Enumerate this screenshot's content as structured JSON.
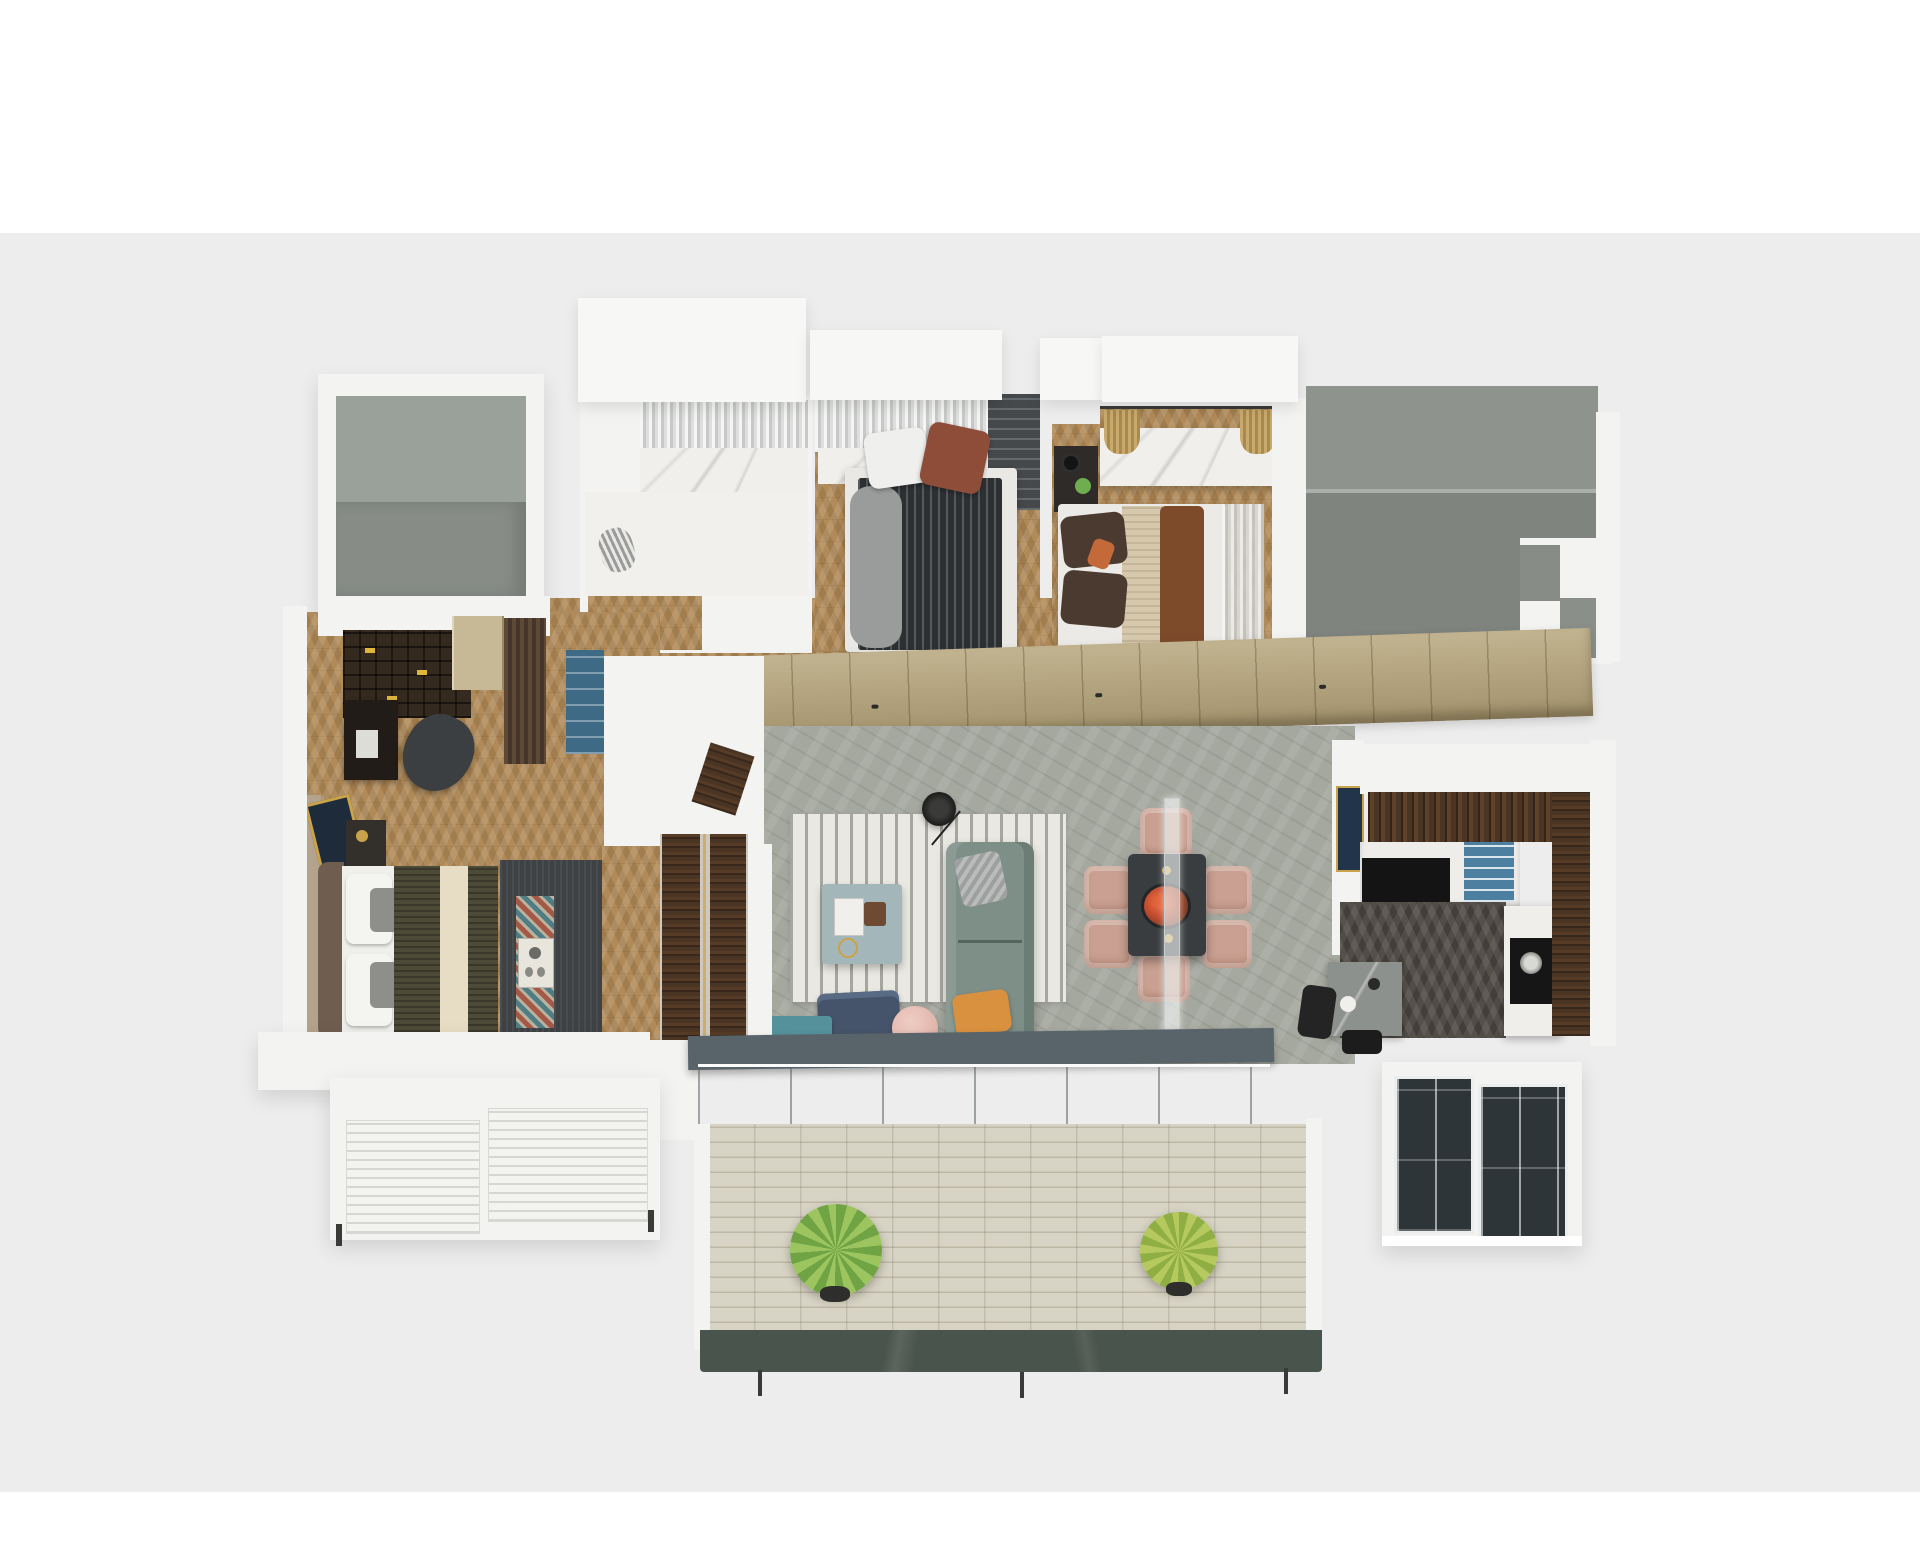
{
  "scene": {
    "type": "3d-floor-plan-render",
    "view": "top-down axonometric render of a three-bedroom apartment",
    "background_top": "#ffffff",
    "background_band": "#ededed",
    "has_text": false
  },
  "palette": {
    "wall_white": "#f3f3f1",
    "roof_white": "#f7f7f5",
    "terrace_gray_light": "#9aa09a",
    "terrace_gray_dark": "#878c87",
    "void_gray_light": "#8e938e",
    "void_gray_dark": "#7f847f",
    "marble_white": "#f0efec",
    "wood_oak": "#b08a58",
    "wood_walnut": "#4a3423",
    "wood_dark_floor": "#56504a",
    "wardrobe_beige": "#b6a784",
    "stone_floor": "#a5a89f",
    "rug_white": "#e9e8e2",
    "sofa_green": "#7e8f88",
    "armchair_navy": "#46546b",
    "pouf_pink": "#e3b8ae",
    "bench_teal": "#55919b",
    "coffee_table_blue": "#a3b7ba",
    "dining_table_dark": "#3a3d3f",
    "chair_pink": "#c9a091",
    "flower_orange": "#e0633a",
    "duvet_dark": "#2d3033",
    "blanket_olive": "#4d4a38",
    "blanket_cream": "#e7ddc4",
    "blanket_beige": "#d6c8ad",
    "throw_brown": "#7d4b2a",
    "pillow_rust": "#8e4d39",
    "pillow_orange": "#d9913f",
    "rug_dark": "#3f4245",
    "runner_teal": "#4f7d85",
    "runner_red": "#a65847",
    "curtain_gray": "#c6c9c7",
    "closet_dark": "#45494c",
    "kitchen_shelf_blue": "#4d7fa0",
    "beam_slate": "#59646a",
    "deck_light": "#d8d4c5",
    "fascia_green": "#49544c",
    "plant_green": "#6fa344",
    "balcony_glass_dark": "#2e3538",
    "art_navy": "#22344a",
    "gold_accent": "#c9a24b",
    "book_yellow": "#e0b63b"
  },
  "rooms": [
    {
      "id": "terrace-room-top-left",
      "floor": "two-tone gray concrete",
      "items": [
        "empty room"
      ]
    },
    {
      "id": "bathroom",
      "floor": "white marble",
      "items": [
        "curtain-wall",
        "marble-shower",
        "white-vanity-floor",
        "zebra-ornament",
        "stool",
        "oak-threshold"
      ]
    },
    {
      "id": "bedroom-2",
      "floor": "herringbone oak",
      "items": [
        "dark-striped-double-bed",
        "white-pillow",
        "rust-pillow",
        "gray-throw",
        "marble-headboard-wall",
        "dark-closet"
      ]
    },
    {
      "id": "bedroom-3",
      "floor": "herringbone oak",
      "items": [
        "beige-double-bed",
        "brown-throw",
        "marble-desk",
        "dried-grass-tassels",
        "nightstand-with-lamp-and-plant",
        "gray-curtain"
      ]
    },
    {
      "id": "study",
      "floor": "herringbone oak",
      "items": [
        "bookshelf",
        "desk",
        "office-chair",
        "tan-closet",
        "brown-curtain",
        "blue-cabinet"
      ]
    },
    {
      "id": "master-bedroom",
      "floor": "herringbone oak",
      "items": [
        "double-bed-olive-cream-blanket",
        "headboard",
        "pillows",
        "dark-rug",
        "zigzag-runner",
        "breakfast-tray",
        "mirror",
        "nightstand",
        "walnut-wardrobe-wall"
      ]
    },
    {
      "id": "living-room",
      "floor": "gray stone slab",
      "items": [
        "striped-rug",
        "green-sofa",
        "silver-pillow",
        "orange-pillow",
        "blue-coffee-table",
        "floor-lamp",
        "navy-armchair",
        "pink-pouf",
        "teal-fringed-bench"
      ]
    },
    {
      "id": "dining-area",
      "floor": "gray stone slab",
      "items": [
        "dark-dining-table",
        "six-pink-chairs",
        "orange-flower-centerpiece",
        "glass-partition"
      ]
    },
    {
      "id": "kitchen",
      "floor": "dark herringbone",
      "items": [
        "white-wall-with-navy-art",
        "walnut-counter",
        "white-cabinets",
        "black-cabinet",
        "blue-shelves",
        "island-with-cooktop",
        "walnut-panel-wall",
        "bistro-table",
        "stool"
      ]
    },
    {
      "id": "void-terrace-right",
      "floor": "two-tone gray",
      "items": [
        "white-steps"
      ]
    },
    {
      "id": "balcony-main",
      "floor": "light plank deck",
      "items": [
        "slate-beam",
        "glass-doors",
        "plant-left",
        "plant-right",
        "green-marble-fascia",
        "railing-posts"
      ]
    },
    {
      "id": "balcony-master",
      "items": [
        "white-slatted-units"
      ]
    },
    {
      "id": "balcony-kitchen",
      "items": [
        "dark-glass-windows",
        "white-sill"
      ]
    }
  ]
}
